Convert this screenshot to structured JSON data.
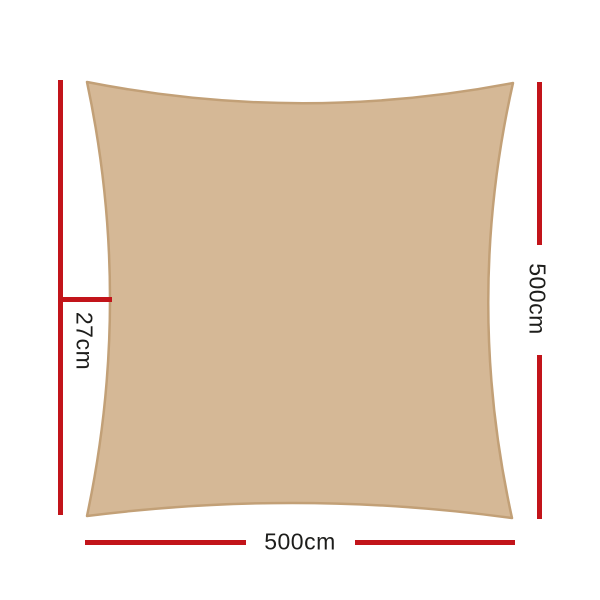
{
  "diagram": {
    "dimensions": {
      "left_label": "27cm",
      "right_label": "500cm",
      "bottom_label": "500cm"
    },
    "colors": {
      "sail-fill": "#d5b896",
      "sail-edge": "#c2a077",
      "dimension-red": "#c2141a",
      "label-text": "#1d1d1b",
      "background": "#ffffff"
    }
  }
}
